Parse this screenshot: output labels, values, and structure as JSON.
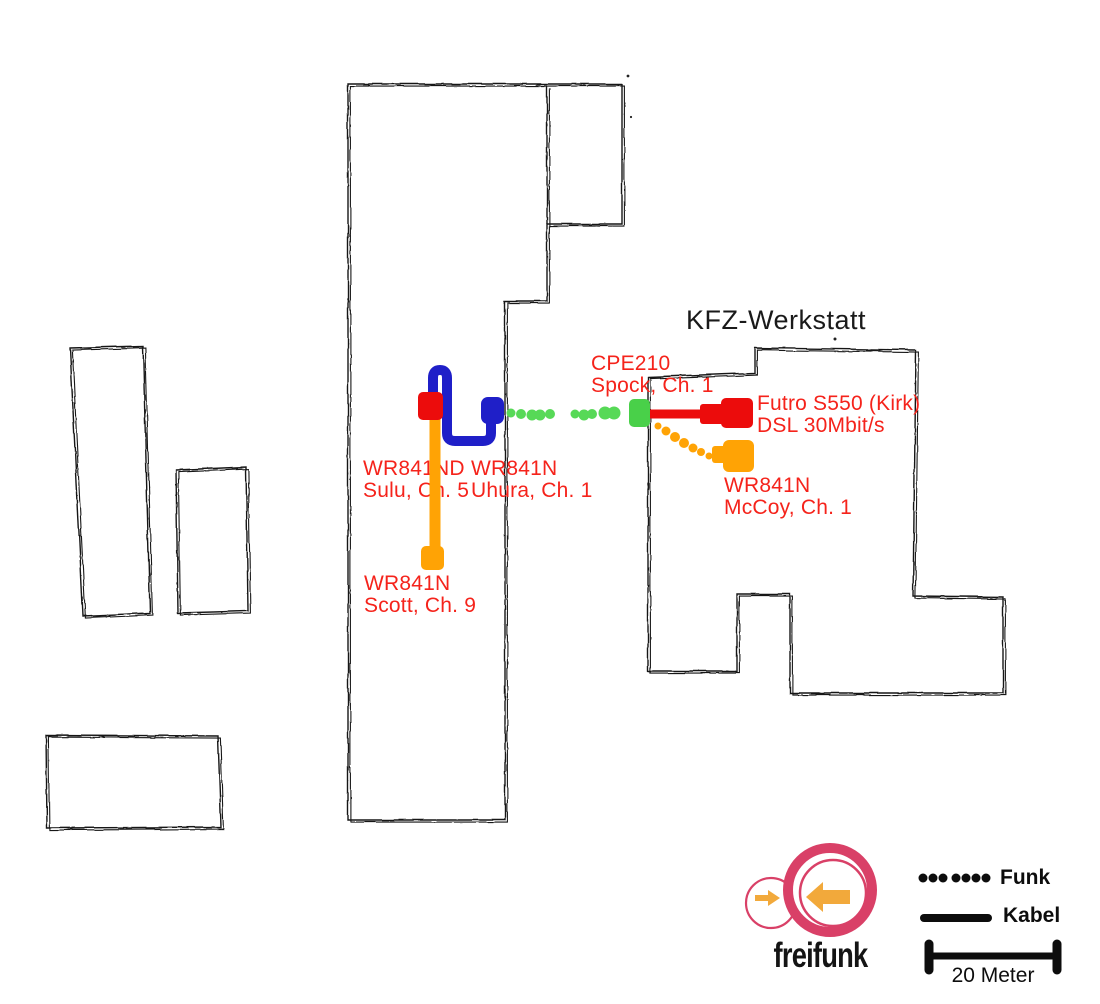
{
  "title": {
    "kfz": "KFZ-Werkstatt"
  },
  "nodes": {
    "sulu": {
      "line1": "WR841ND",
      "line2": "Sulu, Ch. 5"
    },
    "uhura": {
      "line1": "WR841N",
      "line2": "Uhura, Ch. 1"
    },
    "scott": {
      "line1": "WR841N",
      "line2": "Scott, Ch. 9"
    },
    "spock": {
      "line1": "CPE210",
      "line2": "Spock, Ch. 1"
    },
    "kirk": {
      "line1": "Futro S550 (Kirk)",
      "line2": "DSL 30Mbit/s"
    },
    "mccoy": {
      "line1": "WR841N",
      "line2": "McCoy, Ch. 1"
    }
  },
  "connections": [
    {
      "from": "Sulu",
      "to": "Uhura",
      "type": "Kabel",
      "color": "#1f1fc8"
    },
    {
      "from": "Sulu",
      "to": "Scott",
      "type": "Kabel",
      "color": "#ffa305"
    },
    {
      "from": "Uhura",
      "to": "Spock",
      "type": "Funk",
      "color": "#52d452"
    },
    {
      "from": "Spock",
      "to": "Kirk",
      "type": "Kabel",
      "color": "#ec0c0c"
    },
    {
      "from": "Spock",
      "to": "McCoy",
      "type": "Funk",
      "color": "#ffa305"
    }
  ],
  "legend": {
    "funk": "Funk",
    "kabel": "Kabel",
    "scale": "20 Meter"
  },
  "logo": {
    "wordmark": "freifunk",
    "ring_color": "#d94067",
    "arrow_color": "#f2a93b"
  },
  "colors": {
    "node_red": "#ec0c0c",
    "node_blue": "#1f1fc8",
    "node_green": "#49d049",
    "dot_green": "#57d957",
    "node_orange": "#ffa305",
    "label_red": "#f5231b",
    "outline_black": "#141414"
  }
}
